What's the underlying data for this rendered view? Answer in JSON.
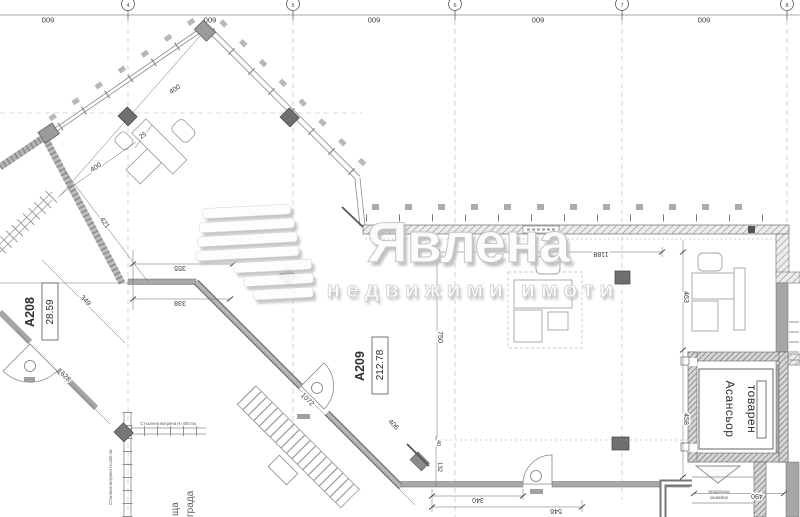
{
  "watermark": {
    "brand": "Явлена",
    "tagline": "недвижими имоти"
  },
  "rooms": {
    "a208": {
      "tag": "A208",
      "area": "28.59"
    },
    "a209": {
      "tag": "A209",
      "area": "212.78"
    }
  },
  "elevator": {
    "label_line1": "Асансьор",
    "label_line2": "товарен"
  },
  "conveyor": {
    "label_line1": "вход/изход",
    "label_line2": "конвейер"
  },
  "labels": {
    "glass_horizontal": "Стъклена витрина Н=400 см",
    "glass_vertical": "Стъклена витрина Н=400 см",
    "street_partial_1": "ща",
    "street_partial_2": "града"
  },
  "grid": {
    "axes": [
      "4",
      "5",
      "6",
      "7",
      "8"
    ],
    "bay_dims": [
      "600",
      "600",
      "600",
      "600",
      "600"
    ]
  },
  "dimensions": {
    "d400_upper": "400",
    "d400_lower": "400",
    "d25": "25",
    "d421": "421",
    "d349": "349",
    "d628": "628",
    "d355": "355",
    "d338": "338",
    "d1072": "1072",
    "d406": "406",
    "d750": "750",
    "d1188": "1188",
    "d463": "463",
    "d458": "458",
    "d340": "340",
    "d546": "546",
    "d490": "490",
    "d132": "132",
    "d40": "40"
  }
}
